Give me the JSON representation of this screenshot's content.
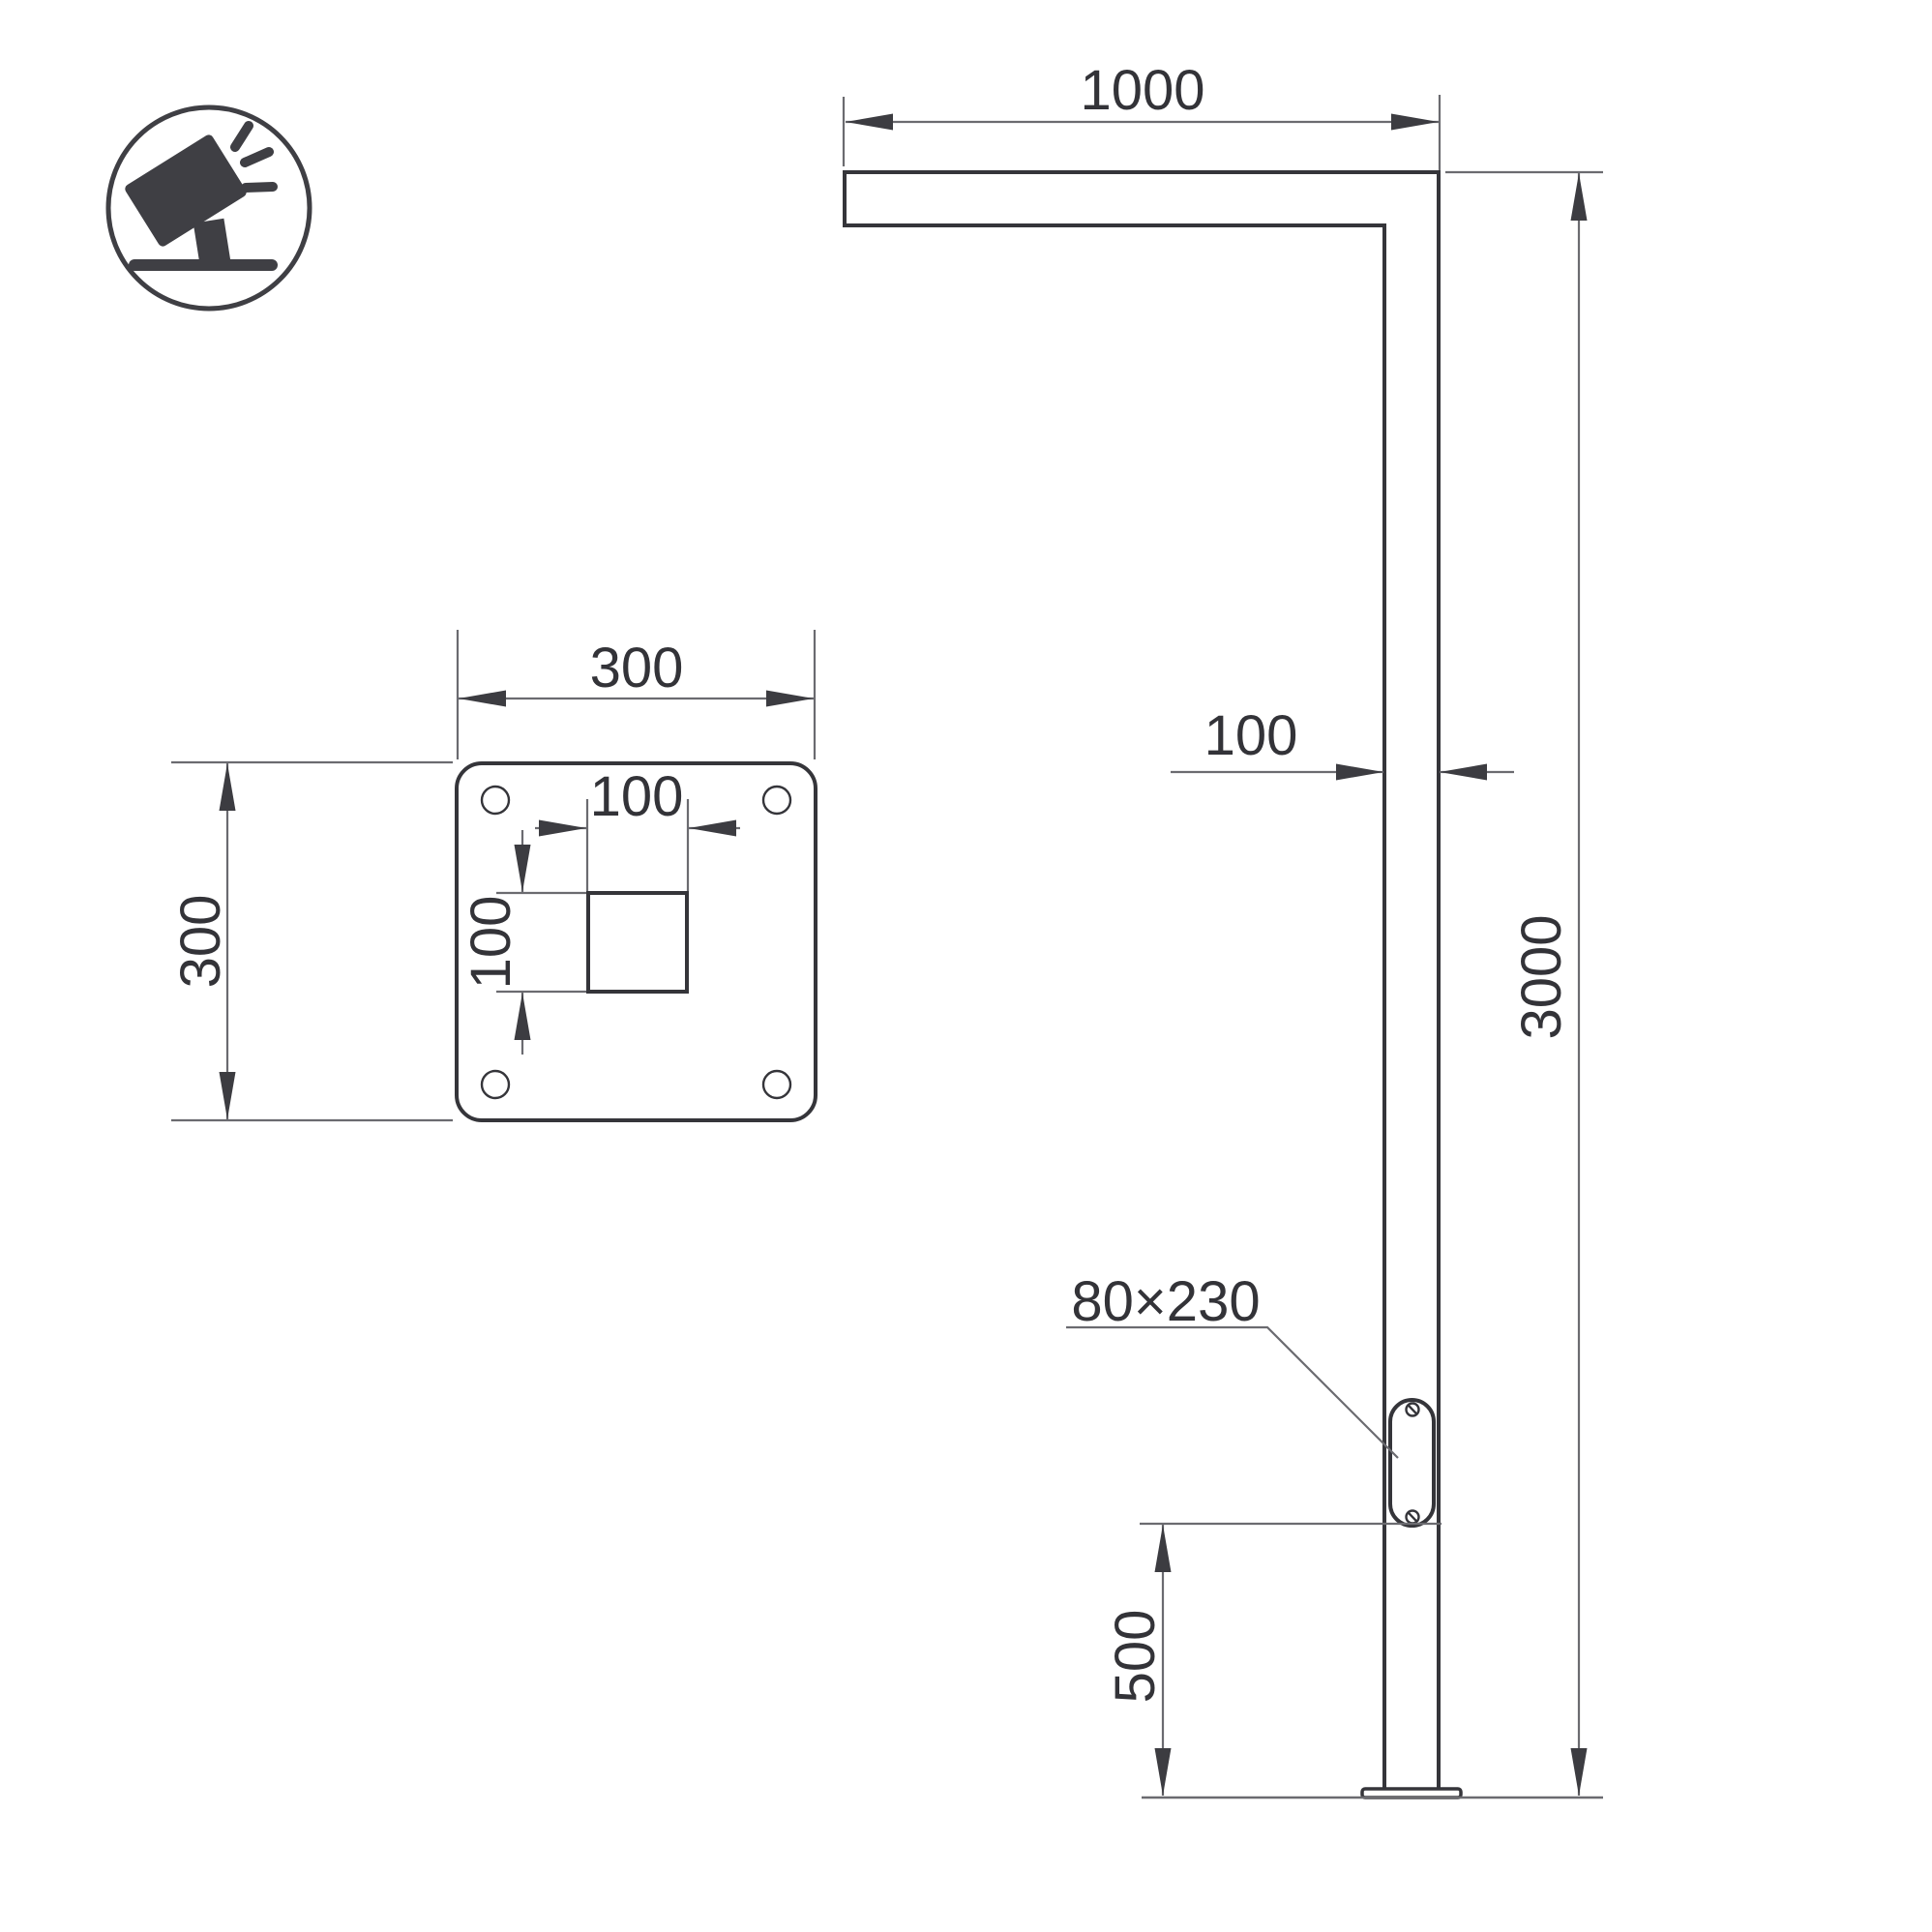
{
  "colors": {
    "background": "#ffffff",
    "outline": "#35353a",
    "dimension_lines": "#6b6b70",
    "text": "#333338",
    "icon": "#3f3f44"
  },
  "icon": {
    "name": "tilted-floodlight-icon"
  },
  "plate_view": {
    "plate_width": "300",
    "plate_height": "300",
    "cutout_width": "100",
    "cutout_height": "100"
  },
  "pole_view": {
    "arm_length": "1000",
    "pole_width": "100",
    "pole_height": "3000",
    "door_size": "80×230",
    "door_bottom_offset": "500"
  }
}
